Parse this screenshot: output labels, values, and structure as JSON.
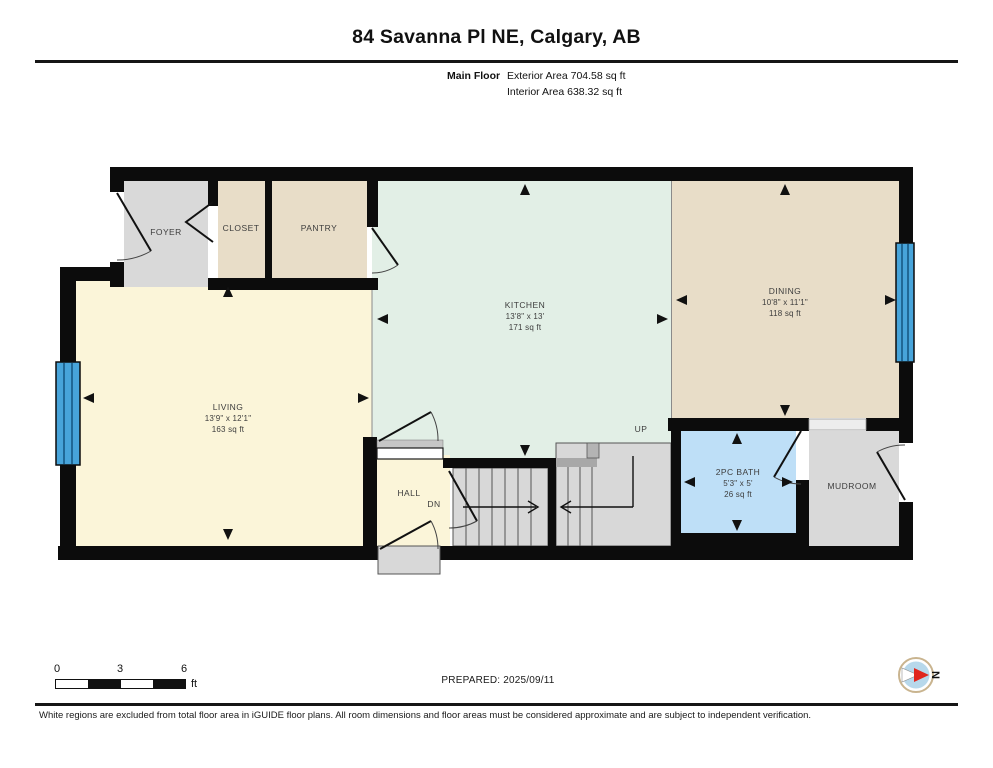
{
  "header": {
    "title": "84 Savanna Pl NE, Calgary, AB",
    "floor_label": "Main Floor",
    "exterior_area": "Exterior Area 704.58 sq ft",
    "interior_area": "Interior Area 638.32 sq ft"
  },
  "rooms": {
    "foyer": {
      "label": "FOYER"
    },
    "closet": {
      "label": "CLOSET"
    },
    "pantry": {
      "label": "PANTRY"
    },
    "kitchen": {
      "label": "KITCHEN",
      "dims": "13'8\" x 13'",
      "area": "171 sq ft"
    },
    "dining": {
      "label": "DINING",
      "dims": "10'8\" x 11'1\"",
      "area": "118 sq ft"
    },
    "living": {
      "label": "LIVING",
      "dims": "13'9\" x 12'1\"",
      "area": "163 sq ft"
    },
    "hall": {
      "label": "HALL"
    },
    "bath": {
      "label": "2PC BATH",
      "dims": "5'3\" x 5'",
      "area": "26 sq ft"
    },
    "mudroom": {
      "label": "MUDROOM"
    }
  },
  "stairs": {
    "up": "UP",
    "down": "DN"
  },
  "scale_bar": {
    "ticks": [
      "0",
      "3",
      "6"
    ],
    "unit": "ft"
  },
  "compass": {
    "label": "N"
  },
  "footer": {
    "prepared": "PREPARED: 2025/09/11",
    "disclaimer": "White regions are excluded from total floor area in iGUIDE floor plans. All room dimensions and floor areas must be considered approximate and are subject to independent verification."
  },
  "colors": {
    "wall": "#0c0c0c",
    "living_cream": "#fbf5d9",
    "kitchen_mint": "#e2efe6",
    "tan": "#e8ddc8",
    "gray": "#d9d9d9",
    "stair_gray": "#d8d8d8",
    "bath_blue": "#bedff7",
    "window_blue": "#47a4da",
    "compass_red": "#e0261d"
  }
}
